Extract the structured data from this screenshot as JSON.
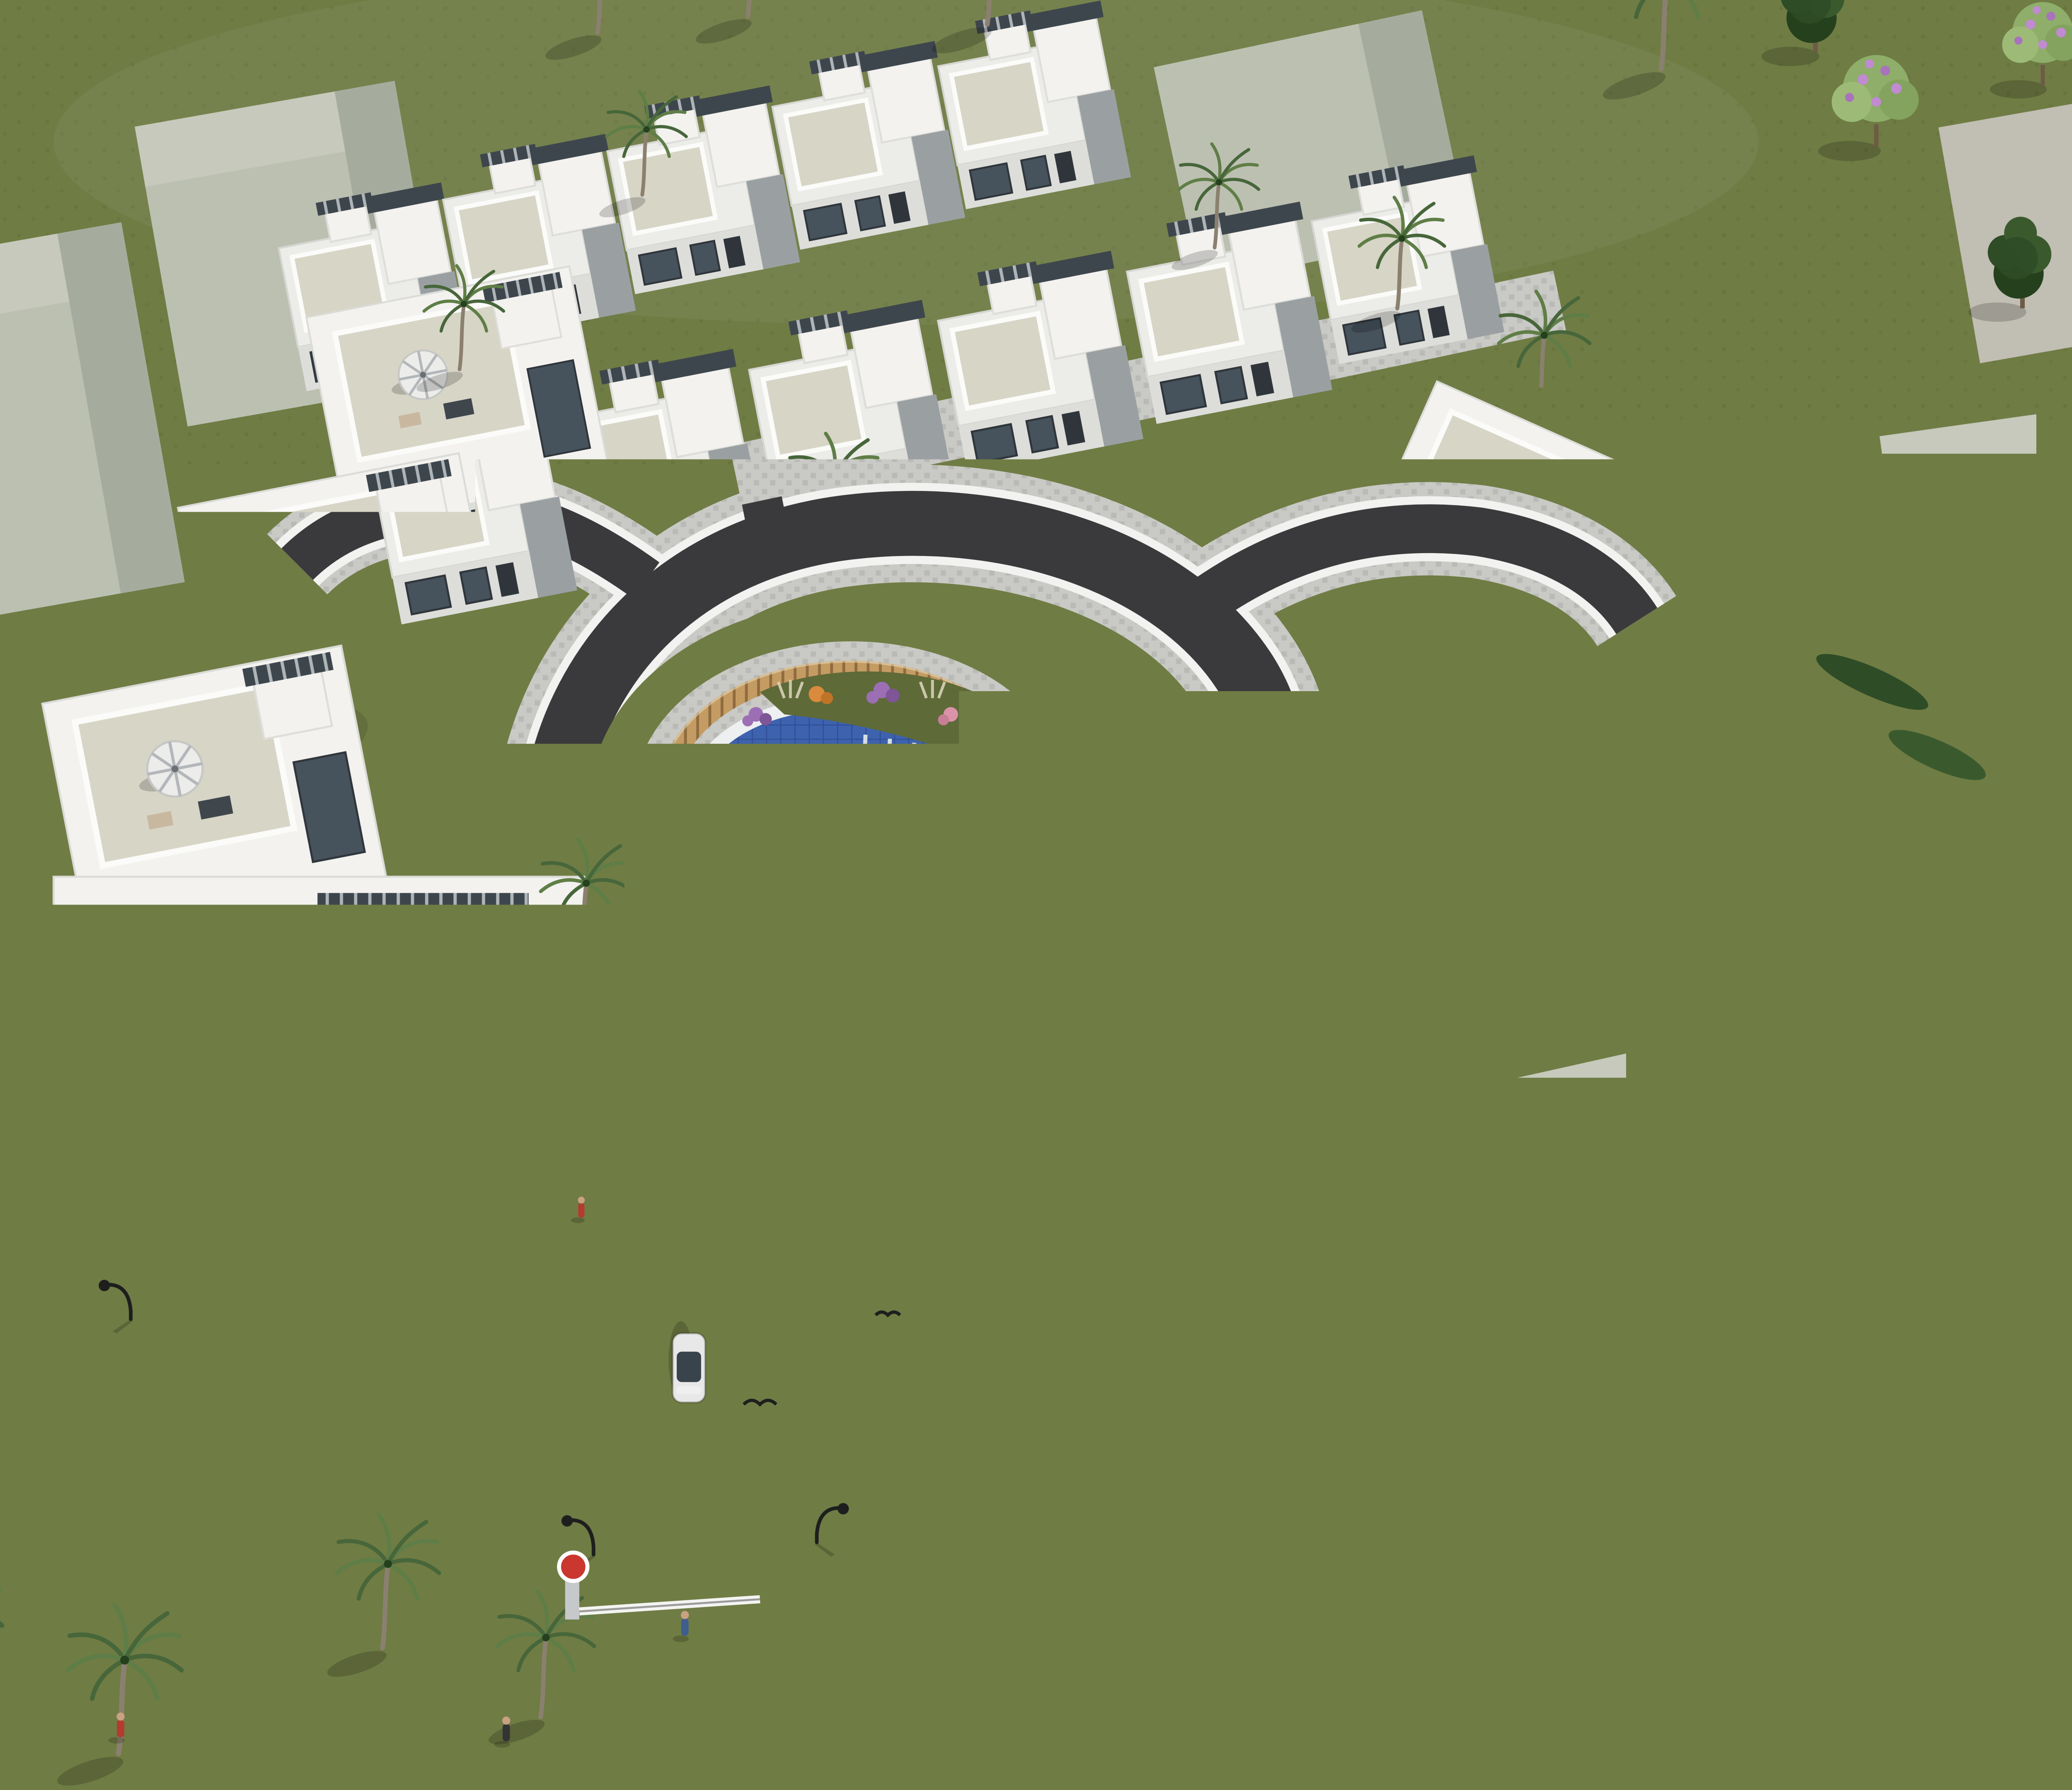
{
  "meta": {
    "title": "Aerial render of a modern villa community",
    "description": "High-angle 3D architectural rendering of a gated residential development: white cubic villas and townhouse rows arranged around a ring road with a central tear-drop community pool on a landscaped roundabout island, an entry road with boom barrier, cobbled sidewalks, date palms, pines and flowering trees on olive-green lawns, with semi-transparent grey context buildings around the site and a red brand mark at the lower right.",
    "view": "aerial three-quarter view, sunlight from upper right, shadows to lower left",
    "visible_text": "none"
  },
  "brand_mark": {
    "shape": "solid red vertical rectangle overlapped by a grey horizontal bar",
    "position": "bottom-right",
    "red": "#EE2B3B",
    "gray": "#5A646E"
  },
  "scene": {
    "ground": "olive-green grass",
    "center_feature": "blue tiled community pool inside a curved timber-plank fence with planted bed, on a cobbled roundabout island",
    "roads": [
      "ring road looping around the pool island",
      "entry road from bottom edge with dashed white centerline, white directional arrow, white car and boom barrier with red sign",
      "north-east branch with yellow car",
      "north-west branch",
      "cobbled courtyard lane between the townhouse rows",
      "cobbled driveway into the east villas with red SUV"
    ],
    "building_groups": [
      {
        "name": "north townhouse rows",
        "units": 9,
        "style": "white cubic townhouses, roof terraces, dark pergola slabs over stair bulkheads"
      },
      {
        "name": "west stepped villas",
        "units": 3,
        "style": "white villas with glass bands, beige roof terraces, striped parasols"
      },
      {
        "name": "east hillside villas",
        "units": 3,
        "style": "stepped white villas with louvred pergolas and terrace lounge"
      },
      {
        "name": "south foreground villa left",
        "units": 1,
        "features": [
          "roof terrace",
          "striped parasol",
          "jacuzzi",
          "slit windows",
          "flower garden"
        ]
      },
      {
        "name": "south foreground villa right",
        "units": 1,
        "features": [
          "roof terrace",
          "striped parasol",
          "plunge pool",
          "slit windows",
          "flower garden"
        ]
      }
    ],
    "context_buildings": "nine semi-transparent grey massing blocks on the surrounding lots",
    "vehicles": [
      {
        "type": "white sedan",
        "location": "entry road"
      },
      {
        "type": "yellow car",
        "location": "north-east branch"
      },
      {
        "type": "red suv",
        "location": "east driveway"
      },
      {
        "type": "dark red car",
        "location": "townhouse lane"
      }
    ],
    "vegetation": [
      "date palms",
      "dark pines",
      "cypresses",
      "purple flowering trees",
      "allium, pink and orange flower beds"
    ],
    "people": "small pedestrian figures on sidewalks and terraces",
    "street_furniture": [
      "curved black street lamps",
      "boom barrier",
      "white road arrows"
    ]
  },
  "colors": {
    "grass": "#6F7C44",
    "grass_dark": "#57642F",
    "road": "#3A3A3C",
    "curb": "#F2F2F0",
    "cobble": "#C9C9C5",
    "cobble_dot": "#B9B9B5",
    "wall_white": "#F3F2EF",
    "wall_shade": "#DDDEDA",
    "face_shade": "#9AA0A2",
    "glass": "#46525C",
    "glass_frame": "#2F353B",
    "terrace": "#D7D5C6",
    "roof_slab": "#ECECE8",
    "accent_dark": "#3E464D",
    "wood": "#C49C63",
    "wood_dark": "#8F6C3F",
    "pool_rim": "#EDEFF0",
    "pool_water": "#3E62AE",
    "pool_water_dark": "#2F4F96",
    "ghost": "#C2C5BA",
    "ghost_side": "#ABB0A4",
    "ghost_top": "#CDCFC4",
    "trunk": "#8B8070",
    "palm1": "#5F7E47",
    "palm2": "#47663A",
    "pine1": "#2E4C26",
    "pine2": "#3A5A2E",
    "pine3": "#24401D",
    "bloom_leaf": "#8EAE69",
    "bloom_flower": "#C08BD0",
    "bush_purple": "#9C6FB5",
    "bush_pink": "#DA93A9",
    "bush_orange": "#D98A3C",
    "lamp": "#1E1E1E",
    "car_white": "#E8E8E8",
    "car_yellow": "#D9A62E",
    "car_red": "#B3271E",
    "person_red": "#B53A30",
    "person_blue": "#3E5E8E",
    "skin": "#C9A183",
    "logo_red": "#EE2B3B",
    "logo_gray": "#5A646E"
  }
}
